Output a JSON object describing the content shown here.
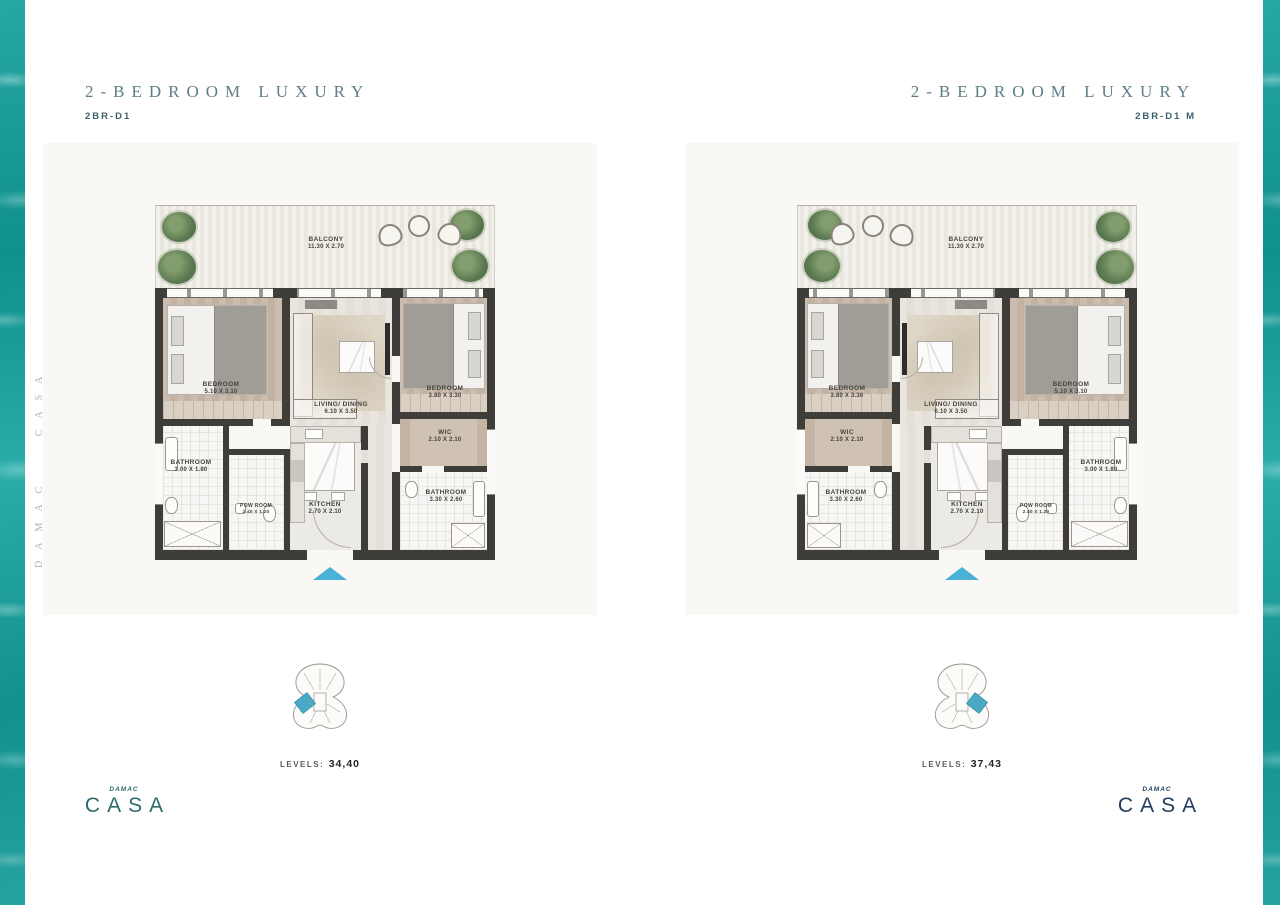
{
  "pages": {
    "left": {
      "title": "2-BEDROOM LUXURY",
      "subtitle": "2BR-D1",
      "levels_label": "LEVELS:",
      "levels_value": "34,40"
    },
    "right": {
      "title": "2-BEDROOM LUXURY",
      "subtitle": "2BR-D1 M",
      "levels_label": "LEVELS:",
      "levels_value": "37,43"
    }
  },
  "rooms": {
    "balcony": {
      "name": "BALCONY",
      "dims": "11.30 X 2.70"
    },
    "bedroom_left": {
      "name": "BEDROOM",
      "dims": "5.10 X 3.10"
    },
    "living": {
      "name": "LIVING/ DINING",
      "dims": "6.10 X 3.50"
    },
    "bedroom_right": {
      "name": "BEDROOM",
      "dims": "3.80 X 3.30"
    },
    "wic": {
      "name": "WIC",
      "dims": "2.10 X 2.10"
    },
    "bathroom_small": {
      "name": "BATHROOM",
      "dims": "3.00 X 1.80"
    },
    "pow": {
      "name": "POW ROOM",
      "dims": "2.40 X 1.20"
    },
    "kitchen": {
      "name": "KITCHEN",
      "dims": "2.70 X 2.10"
    },
    "bathroom_large": {
      "name": "BATHROOM",
      "dims": "3.30 X 2.60"
    }
  },
  "side_texts": {
    "left": "DAMAC CASA",
    "right": "ESCAPE TO AN ISLAND IN THE SKY"
  },
  "logo": {
    "brand": "DAMAC",
    "name": "CASA"
  },
  "colors": {
    "water": "#149a98",
    "title": "#5d7e86",
    "entry_arrow": "#4bb1d6",
    "keyplan_highlight": "#4ba9c6",
    "logo_left": "#2e6a6a",
    "logo_right": "#22405c"
  }
}
